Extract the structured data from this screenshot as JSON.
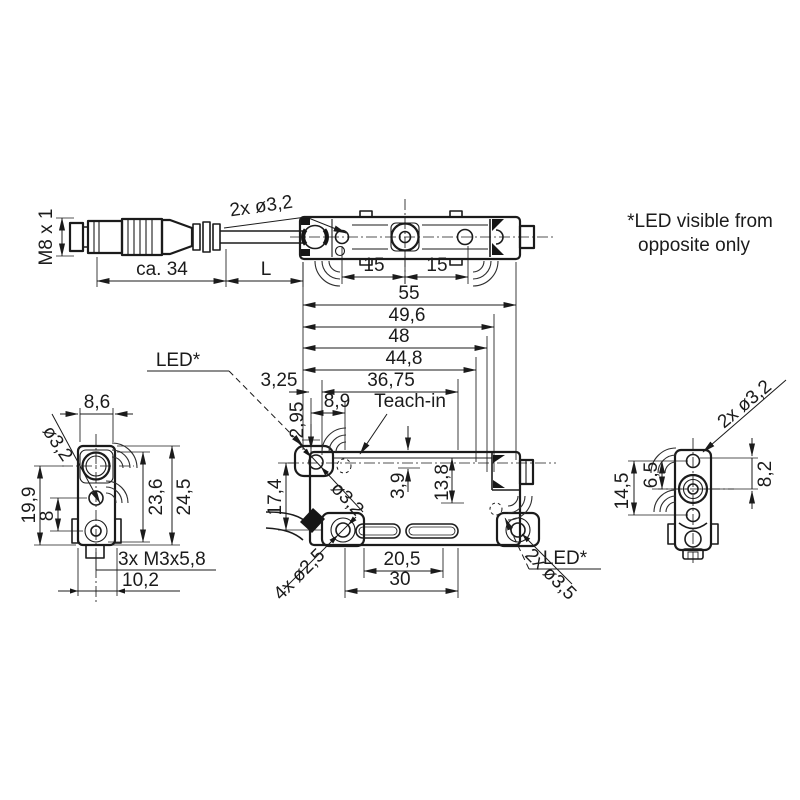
{
  "note": {
    "line1": "*LED visible from",
    "line2": "opposite only"
  },
  "connector_view": {
    "thread": "M8 x 1",
    "body_length": "ca. 34",
    "cable_length": "L",
    "holes": "2x ø3,2"
  },
  "top_view": {
    "pitch1": "15",
    "pitch2": "15"
  },
  "dim_stack": {
    "d55": "55",
    "d49_6": "49,6",
    "d48": "48",
    "d44_8": "44,8",
    "d36_75": "36,75",
    "d8_9": "8,9",
    "teach": "Teach-in",
    "d3_25": "3,25",
    "d2_95": "2,95"
  },
  "front_view": {
    "width": "8,6",
    "lens_hole": "ø3,2",
    "h19_9": "19,9",
    "h8": "8",
    "h23_6": "23,6",
    "h24_5": "24,5",
    "mount_note": "3x M3x5,8",
    "w10_2": "10,2"
  },
  "main_view": {
    "led_top": "LED*",
    "led_bottom": "LED*",
    "h17_4": "17,4",
    "hole3_2": "ø3,2",
    "d3_9": "3,9",
    "d13_8": "13,8",
    "holes2_5": "4x ø2,5",
    "slot20_5": "20,5",
    "slot30": "30",
    "holes3_5": "2x ø3,5"
  },
  "end_view": {
    "holes": "2x ø3,2",
    "h14_5": "14,5",
    "h6_5": "6,5",
    "h8_2": "8,2"
  }
}
